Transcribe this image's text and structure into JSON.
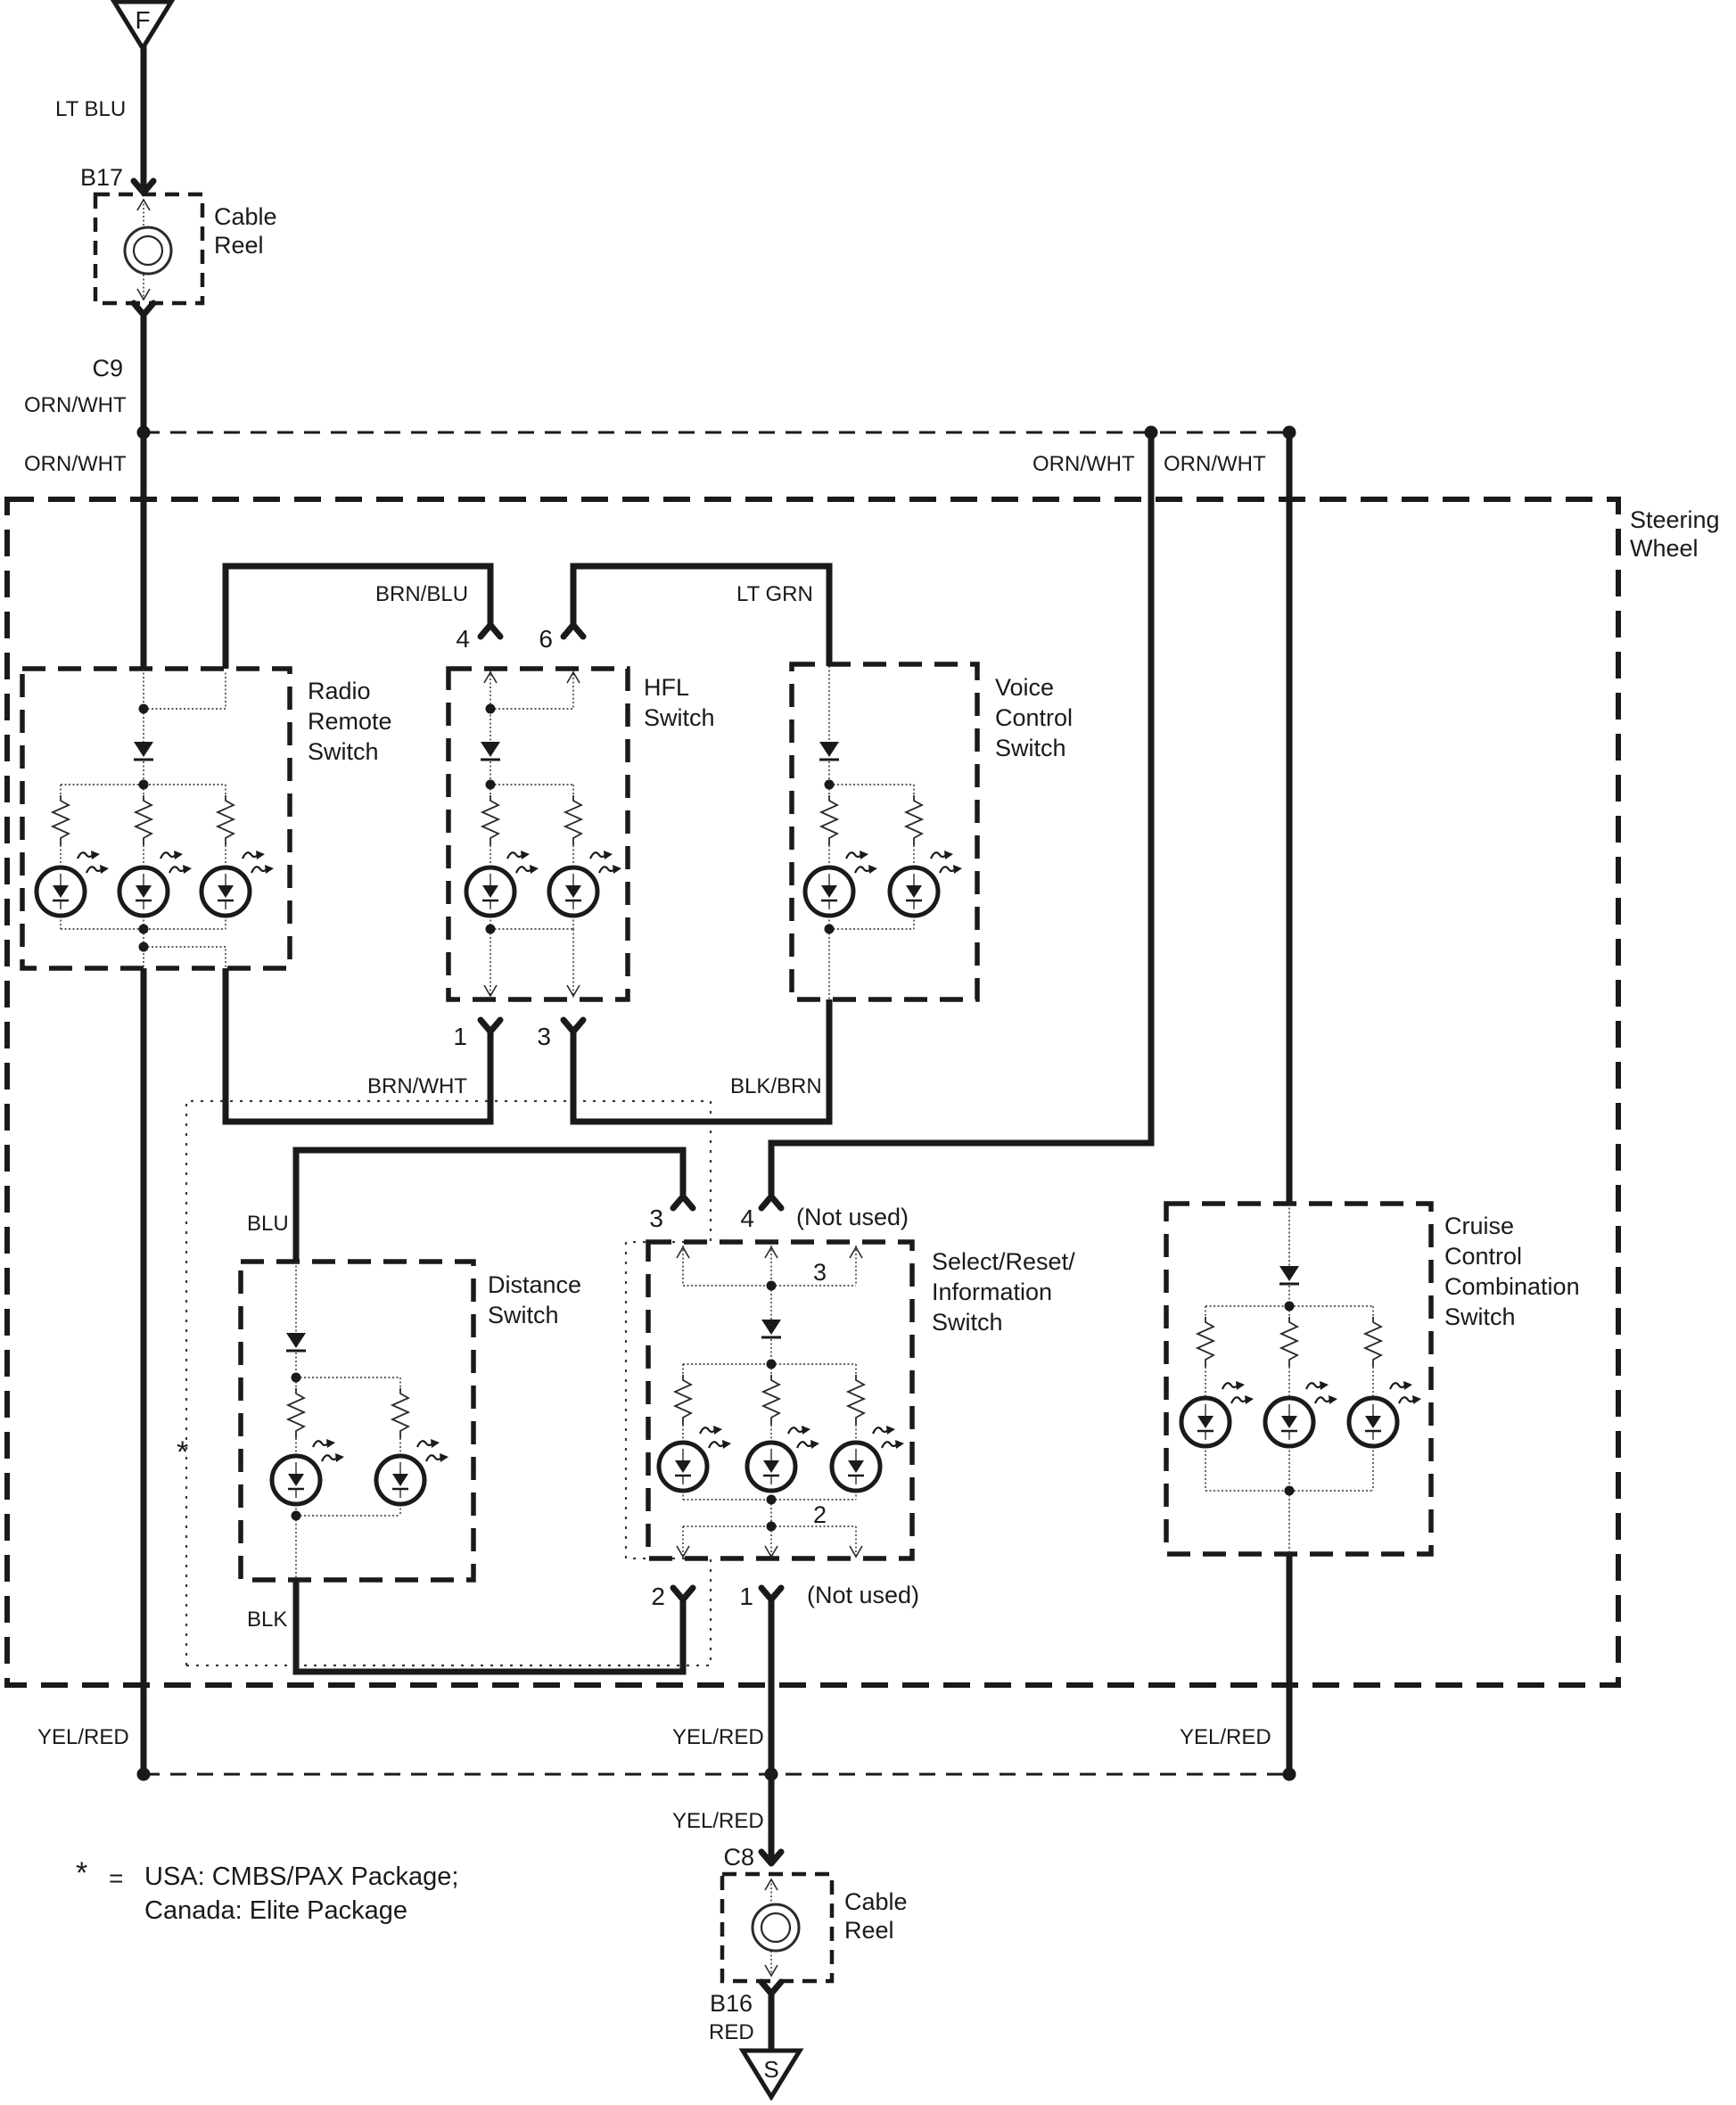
{
  "connectors": {
    "f": "F",
    "b17": "B17",
    "c9": "C9",
    "c8": "C8",
    "b16": "B16",
    "s": "S"
  },
  "wire_labels": {
    "lt_blu": "LT BLU",
    "orn_wht": "ORN/WHT",
    "brn_blu": "BRN/BLU",
    "lt_grn": "LT GRN",
    "brn_wht": "BRN/WHT",
    "blk_brn": "BLK/BRN",
    "blu": "BLU",
    "blk": "BLK",
    "yel_red": "YEL/RED",
    "red": "RED"
  },
  "components": {
    "cable_reel_top": {
      "lines": [
        "Cable",
        "Reel"
      ]
    },
    "steering_wheel": {
      "lines": [
        "Steering",
        "Wheel"
      ]
    },
    "radio_remote": {
      "lines": [
        "Radio",
        "Remote",
        "Switch"
      ]
    },
    "hfl": {
      "lines": [
        "HFL",
        "Switch"
      ]
    },
    "voice_control": {
      "lines": [
        "Voice",
        "Control",
        "Switch"
      ]
    },
    "distance": {
      "lines": [
        "Distance",
        "Switch"
      ]
    },
    "select_reset": {
      "lines": [
        "Select/Reset/",
        "Information",
        "Switch"
      ]
    },
    "cruise": {
      "lines": [
        "Cruise",
        "Control",
        "Combination",
        "Switch"
      ]
    },
    "cable_reel_bottom": {
      "lines": [
        "Cable",
        "Reel"
      ]
    }
  },
  "terminals": {
    "one": "1",
    "two": "2",
    "three": "3",
    "four": "4",
    "six": "6",
    "not_used": "(Not used)",
    "inner_three": "3",
    "inner_two": "2"
  },
  "note": {
    "star": "*",
    "equals": "=",
    "line1": "USA: CMBS/PAX Package;",
    "line2": "Canada: Elite Package"
  },
  "colors": {
    "ink": "#1a1a1a",
    "paper": "#ffffff"
  }
}
